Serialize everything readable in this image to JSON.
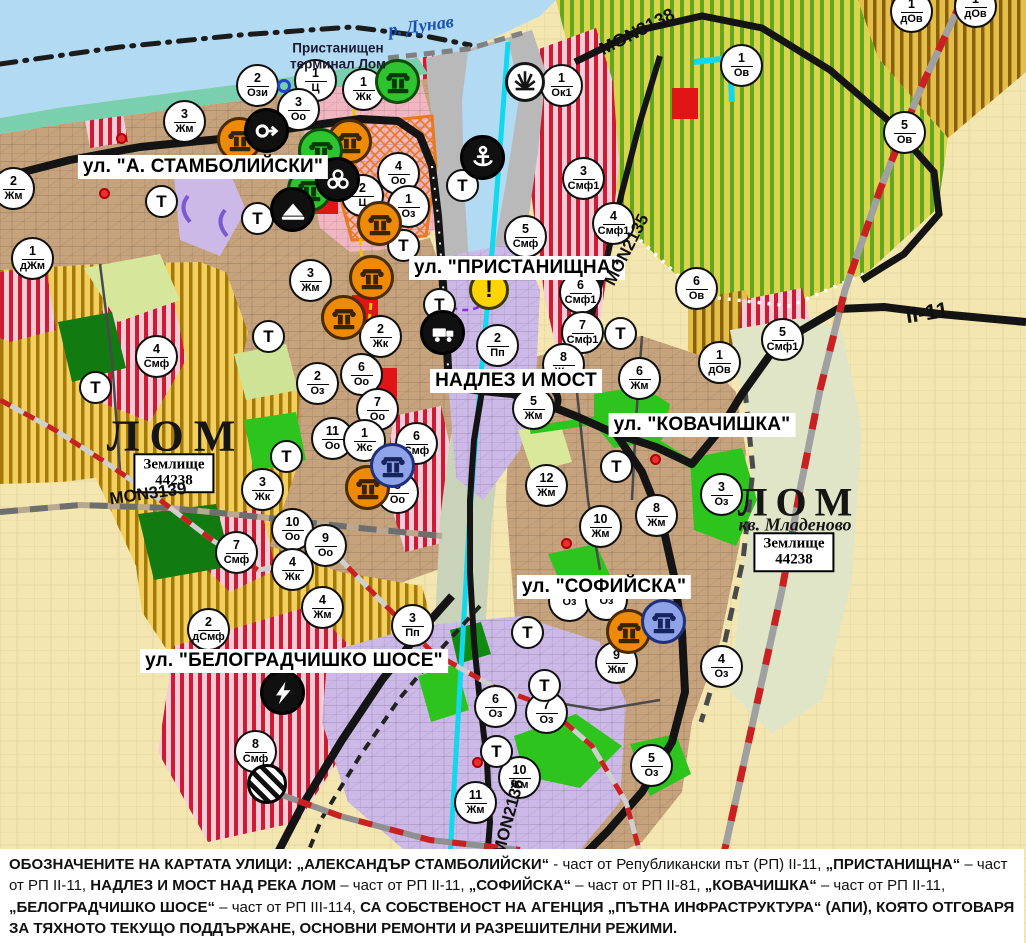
{
  "map": {
    "river_label": {
      "text": "р. Дунав",
      "x": 421,
      "y": 26,
      "rotate": -8
    },
    "terminal_label": {
      "lines": [
        "Пристанищен",
        "терминал Лом"
      ],
      "x": 338,
      "y": 56
    },
    "city_labels": [
      {
        "text": "ЛОМ",
        "x": 176,
        "y": 436,
        "size": 44,
        "spacing": 10,
        "italic": false
      },
      {
        "text": "ЛОМ",
        "x": 799,
        "y": 502,
        "size": 40,
        "spacing": 8,
        "italic": false
      },
      {
        "text": "кв. Младеново",
        "x": 795,
        "y": 525,
        "size": 18,
        "spacing": 0,
        "italic": true
      }
    ],
    "plot_boxes": [
      {
        "line1": "Землище",
        "line2": "44238",
        "x": 174,
        "y": 473
      },
      {
        "line1": "Землище",
        "line2": "44238",
        "x": 794,
        "y": 552
      }
    ],
    "street_labels": [
      {
        "text": "ул. \"А. СТАМБОЛИЙСКИ\"",
        "x": 203,
        "y": 167
      },
      {
        "text": "ул. \"ПРИСТАНИЩНА\"",
        "x": 517,
        "y": 268
      },
      {
        "text": "НАДЛЕЗ И МОСТ",
        "x": 516,
        "y": 381
      },
      {
        "text": "ул. \"КОВАЧИШКА\"",
        "x": 702,
        "y": 425
      },
      {
        "text": "ул. \"СОФИЙСКА\"",
        "x": 604,
        "y": 587
      },
      {
        "text": "ул. \"БЕЛОГРАДЧИШКО ШОСЕ\"",
        "x": 294,
        "y": 661
      }
    ],
    "road_labels": [
      {
        "text": "MON3138",
        "x": 637,
        "y": 32,
        "rotate": -27,
        "size": 18
      },
      {
        "text": "MON2135",
        "x": 627,
        "y": 250,
        "rotate": -63,
        "size": 17
      },
      {
        "text": "MON3139",
        "x": 148,
        "y": 494,
        "rotate": -8,
        "size": 17
      },
      {
        "text": "MON2136",
        "x": 509,
        "y": 817,
        "rotate": -75,
        "size": 17
      },
      {
        "text": "II-11",
        "x": 927,
        "y": 313,
        "rotate": -9,
        "size": 22
      }
    ],
    "terrain_marker_label": "Т",
    "warning_label": "!",
    "zone_markers": [
      {
        "n": "2",
        "code": "Ози",
        "x": 258,
        "y": 86
      },
      {
        "n": "1",
        "code": "Ц",
        "x": 316,
        "y": 81
      },
      {
        "n": "1",
        "code": "Жк",
        "x": 364,
        "y": 90
      },
      {
        "n": "3",
        "code": "Оо",
        "x": 299,
        "y": 110
      },
      {
        "n": "3",
        "code": "Жм",
        "x": 185,
        "y": 122
      },
      {
        "n": "2",
        "code": "Жм",
        "x": 14,
        "y": 189
      },
      {
        "n": "1",
        "code": "дЖм",
        "x": 33,
        "y": 259
      },
      {
        "n": "4",
        "code": "Смф",
        "x": 157,
        "y": 357
      },
      {
        "n": "4",
        "code": "Оо",
        "x": 399,
        "y": 174
      },
      {
        "n": "2",
        "code": "Ц",
        "x": 363,
        "y": 196
      },
      {
        "n": "1",
        "code": "Оз",
        "x": 409,
        "y": 207
      },
      {
        "n": "3",
        "code": "Жм",
        "x": 311,
        "y": 281
      },
      {
        "n": "2",
        "code": "Жк",
        "x": 381,
        "y": 337
      },
      {
        "n": "2",
        "code": "Оз",
        "x": 318,
        "y": 384
      },
      {
        "n": "6",
        "code": "Оо",
        "x": 362,
        "y": 375
      },
      {
        "n": "7",
        "code": "Оо",
        "x": 378,
        "y": 410
      },
      {
        "n": "11",
        "code": "Оо",
        "x": 333,
        "y": 439
      },
      {
        "n": "1",
        "code": "Жс",
        "x": 365,
        "y": 441
      },
      {
        "n": "6",
        "code": "Смф",
        "x": 417,
        "y": 444
      },
      {
        "n": "8",
        "code": "Оо",
        "x": 398,
        "y": 493
      },
      {
        "n": "10",
        "code": "Оо",
        "x": 293,
        "y": 530
      },
      {
        "n": "9",
        "code": "Оо",
        "x": 326,
        "y": 546
      },
      {
        "n": "4",
        "code": "Жк",
        "x": 293,
        "y": 570
      },
      {
        "n": "7",
        "code": "Смф",
        "x": 237,
        "y": 553
      },
      {
        "n": "3",
        "code": "Жк",
        "x": 263,
        "y": 490
      },
      {
        "n": "5",
        "code": "Смф",
        "x": 526,
        "y": 237
      },
      {
        "n": "1",
        "code": "Ок1",
        "x": 562,
        "y": 86
      },
      {
        "n": "3",
        "code": "Смф1",
        "x": 584,
        "y": 179
      },
      {
        "n": "4",
        "code": "Смф1",
        "x": 614,
        "y": 224
      },
      {
        "n": "6",
        "code": "Смф1",
        "x": 581,
        "y": 293
      },
      {
        "n": "7",
        "code": "Смф1",
        "x": 583,
        "y": 333
      },
      {
        "n": "2",
        "code": "Пп",
        "x": 498,
        "y": 346
      },
      {
        "n": "8",
        "code": "Жм",
        "x": 564,
        "y": 365
      },
      {
        "n": "6",
        "code": "Жм",
        "x": 640,
        "y": 379
      },
      {
        "n": "5",
        "code": "Жм",
        "x": 534,
        "y": 409
      },
      {
        "n": "12",
        "code": "Жм",
        "x": 547,
        "y": 486
      },
      {
        "n": "10",
        "code": "Жм",
        "x": 601,
        "y": 527
      },
      {
        "n": "8",
        "code": "Жм",
        "x": 657,
        "y": 516
      },
      {
        "n": "3",
        "code": "Оз",
        "x": 722,
        "y": 495
      },
      {
        "n": "1",
        "code": "Ов",
        "x": 742,
        "y": 66
      },
      {
        "n": "5",
        "code": "Ов",
        "x": 905,
        "y": 133
      },
      {
        "n": "1",
        "code": "дОв",
        "x": 912,
        "y": 12
      },
      {
        "n": "1",
        "code": "дОв",
        "x": 976,
        "y": 7
      },
      {
        "n": "6",
        "code": "Ов",
        "x": 697,
        "y": 289
      },
      {
        "n": "1",
        "code": "дОв",
        "x": 720,
        "y": 363
      },
      {
        "n": "5",
        "code": "Смф1",
        "x": 783,
        "y": 340
      },
      {
        "n": "9",
        "code": "Жм",
        "x": 617,
        "y": 663
      },
      {
        "n": "4",
        "code": "Оз",
        "x": 722,
        "y": 667
      },
      {
        "n": "6",
        "code": "Оз",
        "x": 496,
        "y": 707
      },
      {
        "n": "7",
        "code": "Оз",
        "x": 547,
        "y": 713
      },
      {
        "n": "10",
        "code": "Жм",
        "x": 520,
        "y": 778
      },
      {
        "n": "11",
        "code": "Жм",
        "x": 476,
        "y": 803
      },
      {
        "n": "5",
        "code": "Оз",
        "x": 652,
        "y": 766
      },
      {
        "n": "2",
        "code": "дСмф",
        "x": 209,
        "y": 630
      },
      {
        "n": "4",
        "code": "Жм",
        "x": 323,
        "y": 608
      },
      {
        "n": "3",
        "code": "Пп",
        "x": 413,
        "y": 626
      },
      {
        "n": "8",
        "code": "Смф",
        "x": 256,
        "y": 752
      },
      {
        "n": "",
        "code": "Оз",
        "x": 570,
        "y": 601
      },
      {
        "n": "",
        "code": "Оз",
        "x": 607,
        "y": 600
      }
    ],
    "t_markers": [
      {
        "x": 162,
        "y": 202
      },
      {
        "x": 258,
        "y": 219
      },
      {
        "x": 96,
        "y": 388
      },
      {
        "x": 269,
        "y": 337
      },
      {
        "x": 287,
        "y": 457
      },
      {
        "x": 463,
        "y": 186
      },
      {
        "x": 404,
        "y": 246
      },
      {
        "x": 440,
        "y": 305
      },
      {
        "x": 621,
        "y": 334
      },
      {
        "x": 617,
        "y": 467
      },
      {
        "x": 528,
        "y": 633
      },
      {
        "x": 545,
        "y": 686
      },
      {
        "x": 497,
        "y": 752
      }
    ],
    "icon_markers": [
      {
        "type": "monument",
        "color": "orange",
        "x": 240,
        "y": 140
      },
      {
        "type": "monument",
        "color": "orange",
        "x": 350,
        "y": 142
      },
      {
        "type": "monument",
        "color": "orange",
        "x": 380,
        "y": 224
      },
      {
        "type": "monument",
        "color": "orange",
        "x": 372,
        "y": 278
      },
      {
        "type": "monument",
        "color": "orange",
        "x": 344,
        "y": 318
      },
      {
        "type": "monument",
        "color": "orange",
        "x": 368,
        "y": 488
      },
      {
        "type": "monument",
        "color": "orange",
        "x": 629,
        "y": 632
      },
      {
        "type": "monument",
        "color": "green",
        "x": 398,
        "y": 82
      },
      {
        "type": "monument",
        "color": "green",
        "x": 321,
        "y": 151
      },
      {
        "type": "monument",
        "color": "green",
        "x": 310,
        "y": 190
      },
      {
        "type": "monument",
        "color": "blue",
        "x": 393,
        "y": 466
      },
      {
        "type": "monument",
        "color": "blue",
        "x": 664,
        "y": 622
      },
      {
        "type": "arrow",
        "color": "black",
        "x": 267,
        "y": 131
      },
      {
        "type": "club",
        "color": "black",
        "x": 338,
        "y": 180
      },
      {
        "type": "mound",
        "color": "black",
        "x": 293,
        "y": 210
      },
      {
        "type": "anchor",
        "color": "black",
        "x": 483,
        "y": 158
      },
      {
        "type": "fan",
        "color": "white",
        "x": 525,
        "y": 82
      },
      {
        "type": "warning",
        "color": "yellow",
        "x": 489,
        "y": 290
      },
      {
        "type": "truck",
        "color": "black",
        "x": 443,
        "y": 333
      },
      {
        "type": "lightning",
        "color": "black",
        "x": 283,
        "y": 693
      },
      {
        "type": "railway",
        "color": "striped",
        "x": 267,
        "y": 784
      }
    ],
    "red_dots": [
      {
        "x": 121,
        "y": 138
      },
      {
        "x": 104,
        "y": 193
      },
      {
        "x": 655,
        "y": 459
      },
      {
        "x": 566,
        "y": 543
      },
      {
        "x": 477,
        "y": 762
      }
    ],
    "blue_rings": [
      {
        "x": 284,
        "y": 86
      }
    ]
  },
  "icon_styles": {
    "monument-orange": {
      "bg": "#ef8a06",
      "border": "#4a2c00",
      "glyph": "#3a2300"
    },
    "monument-green": {
      "bg": "#2fc32f",
      "border": "#0b4d07",
      "glyph": "#07380a"
    },
    "monument-blue": {
      "bg": "#8fa4e8",
      "border": "#20307a",
      "glyph": "#17235c"
    },
    "black": {
      "bg": "#101010",
      "border": "#000000",
      "glyph": "#ffffff"
    },
    "white": {
      "bg": "#ffffff",
      "border": "#151515",
      "glyph": "#151515"
    },
    "yellow": {
      "bg": "#ffd400",
      "border": "#3a3a00",
      "glyph": "#101010"
    },
    "striped": {
      "bg": "#101010",
      "border": "#000000",
      "glyph": "#ffffff"
    }
  },
  "palette": {
    "water": "#b3daf3",
    "shore": "#79cfae",
    "urban_tan": "#c6a37d",
    "center_pink": "#f1b6c2",
    "industry_purple": "#cdb9e8",
    "port_gray": "#b9b9b9",
    "green_zone": "#2dc51d",
    "forest": "#117a11",
    "meadow": "#dfe5c6",
    "agri_beige": "#f4e6b0",
    "smf_stripe": "#ce1a32",
    "channel_cyan": "#0fd8ef",
    "boundary_red": "#c92121"
  },
  "note": {
    "segments": [
      {
        "text": "ОБОЗНАЧЕНИТЕ НА КАРТАТА УЛИЦИ: „АЛЕКСАНДЪР СТАМБОЛИЙСКИ“",
        "bold": true
      },
      {
        "text": " - част от Републикански път (РП) II-11, ",
        "bold": false
      },
      {
        "text": "„ПРИСТАНИЩНА“",
        "bold": true
      },
      {
        "text": " – част от РП II-11, ",
        "bold": false
      },
      {
        "text": "НАДЛЕЗ И МОСТ НАД РЕКА ЛОМ",
        "bold": true
      },
      {
        "text": " – част от РП II-11, ",
        "bold": false
      },
      {
        "text": "„СОФИЙСКА“",
        "bold": true
      },
      {
        "text": " – част от РП II-81, ",
        "bold": false
      },
      {
        "text": "„КОВАЧИШКА“",
        "bold": true
      },
      {
        "text": " – част от РП II-11, ",
        "bold": false
      },
      {
        "text": "„БЕЛОГРАДЧИШКО ШОСЕ“",
        "bold": true
      },
      {
        "text": " – част от РП III-114, ",
        "bold": false
      },
      {
        "text": "СА СОБСТВЕНОСТ НА АГЕНЦИЯ „ПЪТНА ИНФРАСТРУКТУРА“ (АПИ), КОЯТО ОТГОВАРЯ ЗА ТЯХНОТО ТЕКУЩО ПОДДЪРЖАНЕ, ОСНОВНИ РЕМОНТИ И РАЗРЕШИТЕЛНИ РЕЖИМИ.",
        "bold": true
      }
    ]
  }
}
